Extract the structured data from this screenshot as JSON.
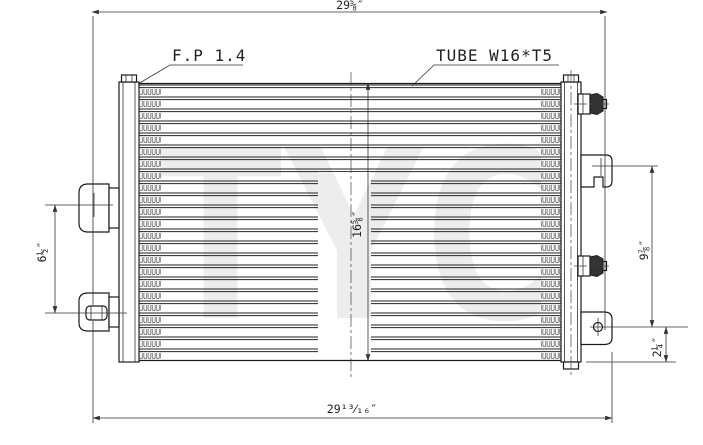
{
  "watermark": "TYC",
  "labels": {
    "fin_pitch": "F.P 1.4",
    "tube_spec": "TUBE W16*T5"
  },
  "dimensions": {
    "top_width": "29⅝″",
    "bottom_width": "29¹³⁄₁₆″",
    "core_height": "16⅝″",
    "left_span": "6½″",
    "right_span": "9⅞″",
    "bottom_offset": "2¼″"
  },
  "colors": {
    "line": "#1a1a1a",
    "dim": "#333333",
    "fin": "#555555",
    "watermark": "#ededed",
    "cap_fill": "#333333"
  }
}
